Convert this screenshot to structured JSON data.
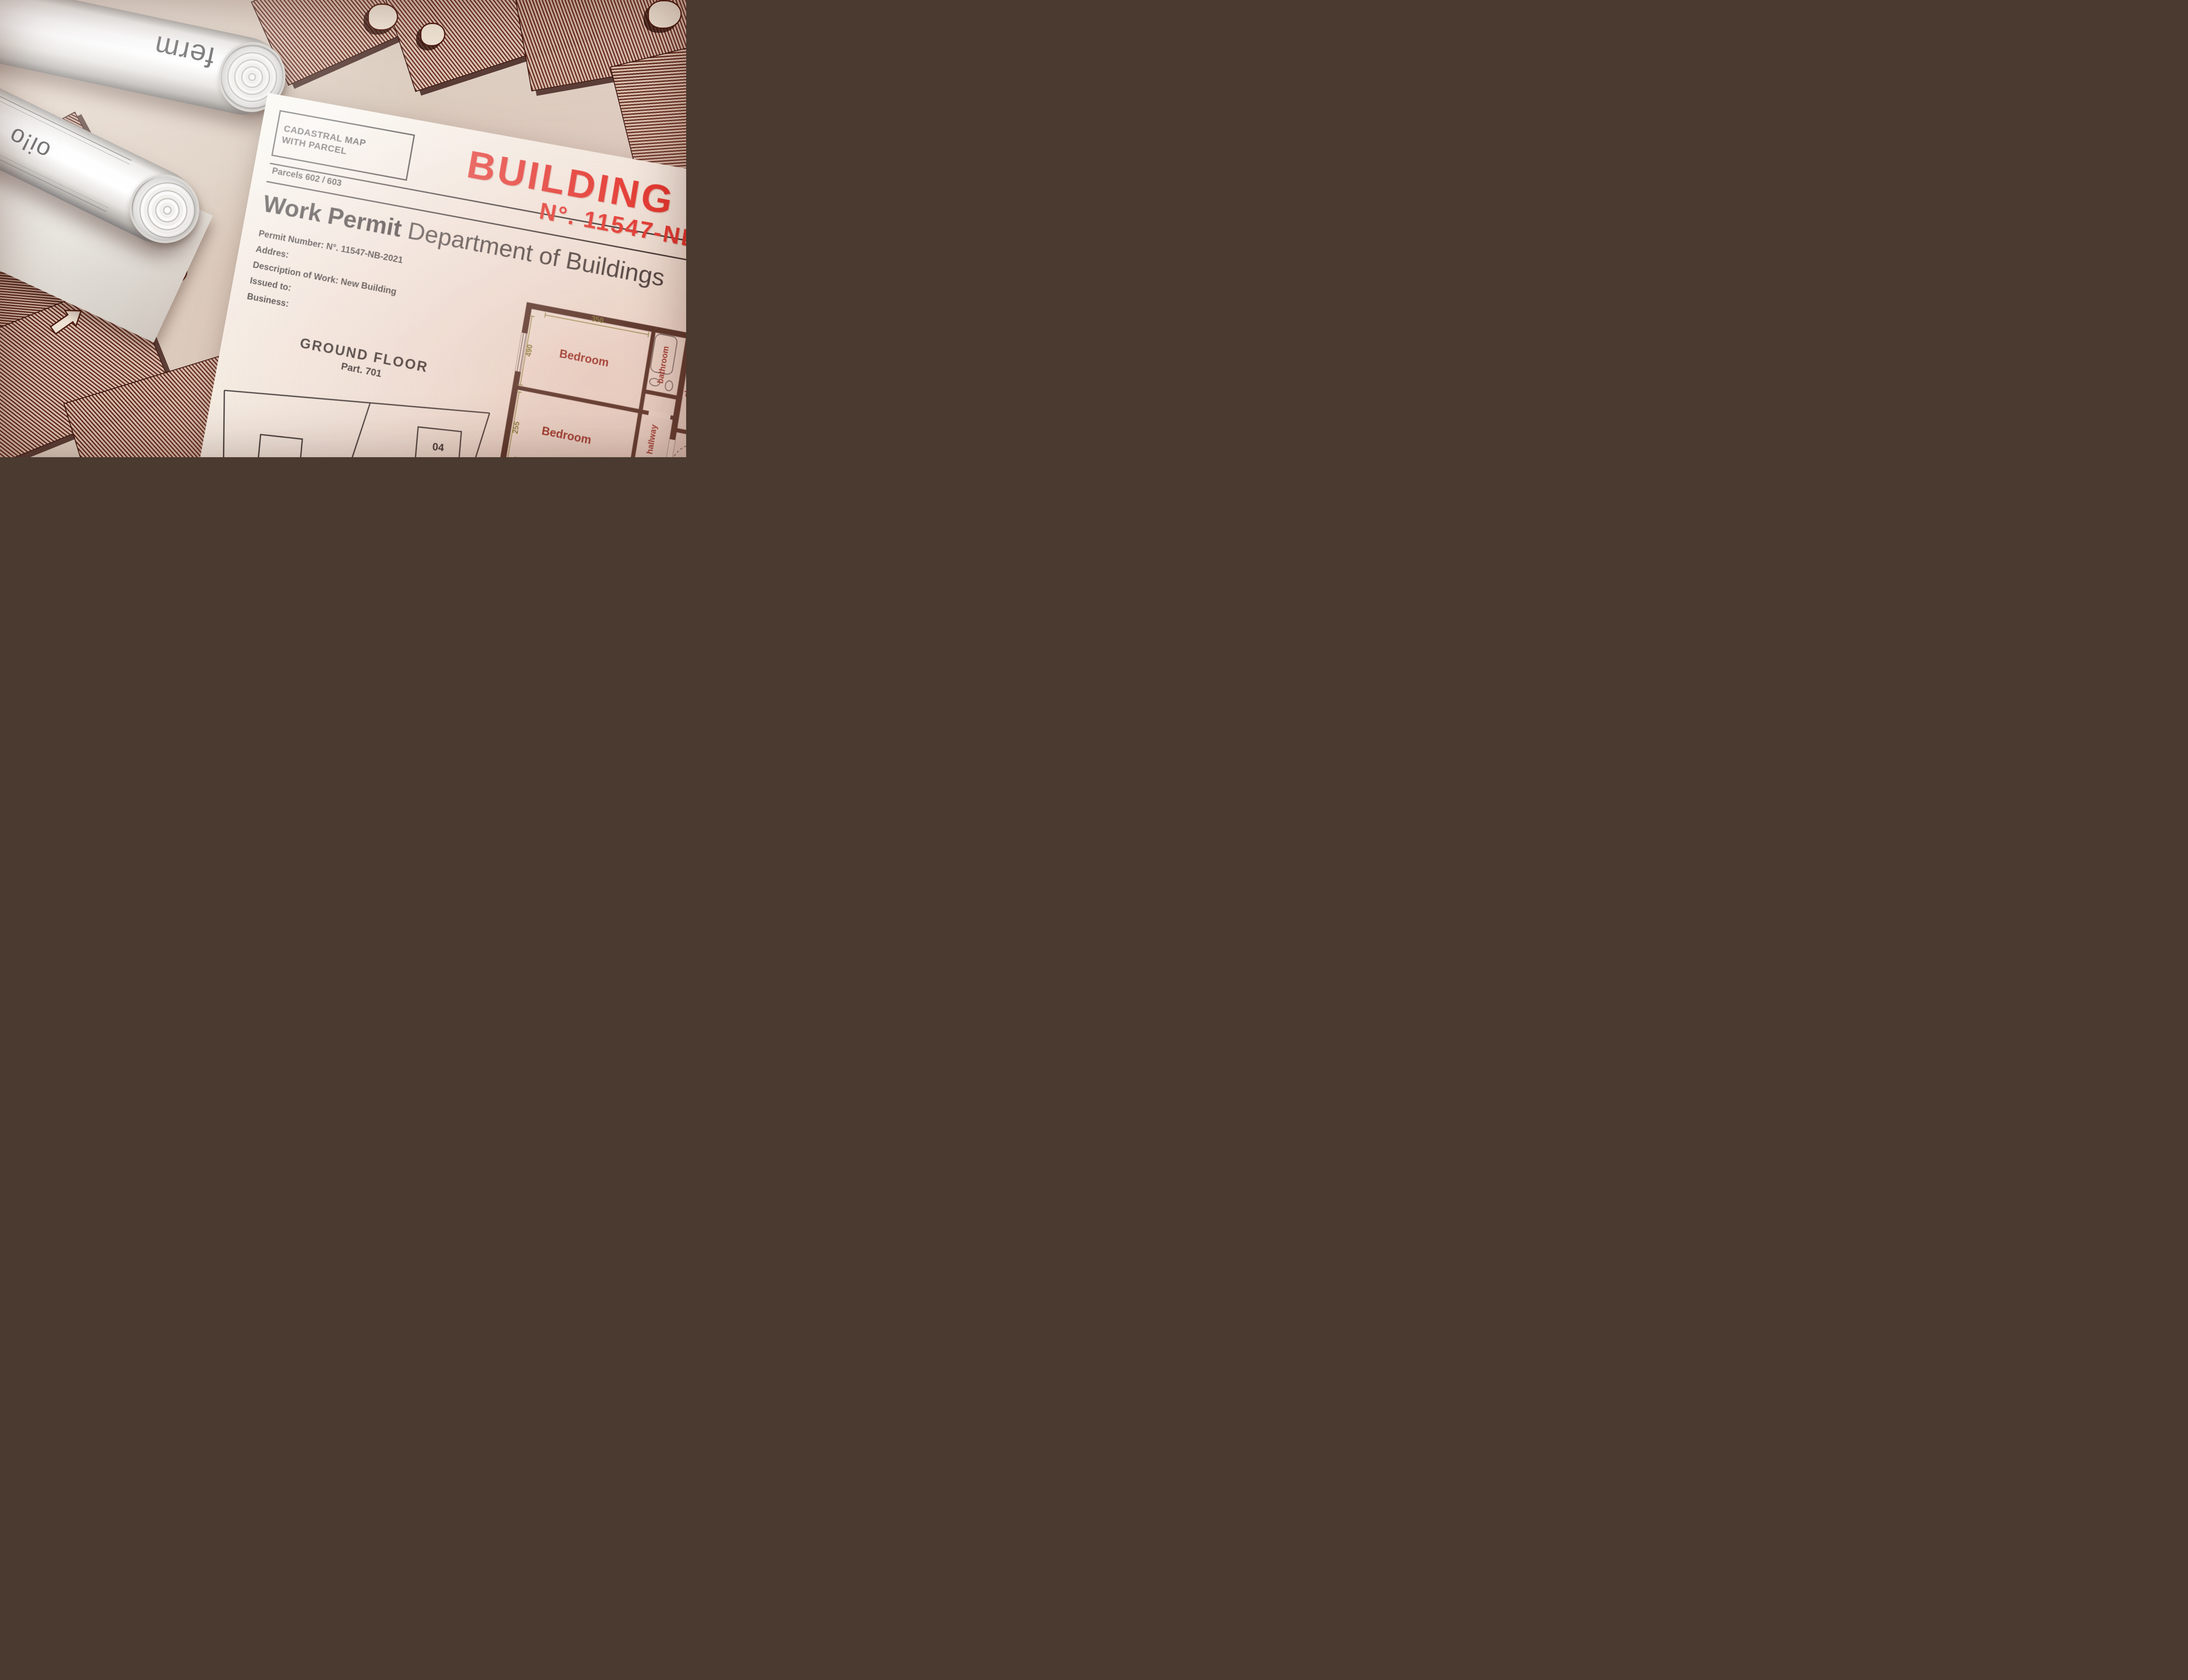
{
  "rolls": {
    "word1": "ferm",
    "word2": "oi!o",
    "badge": "19"
  },
  "doc": {
    "cadastral1": "CADASTRAL MAP",
    "cadastral2": "WITH PARCEL",
    "parcels": "Parcels 602 / 603",
    "title1": "BUILDING PERMIT",
    "title2": "N°. 11547-NB-2022",
    "sub_bold": "Work Permit",
    "sub_rest": "Department of Buildings",
    "fields": [
      "Permit Number: N°. 11547-NB-2021",
      "Addres:",
      "Description of Work: New Building",
      "Issued to:",
      "Business:"
    ],
    "protocol1": "Protocol n° 24459866",
    "protocol_date": "of 11/12/2021",
    "protocol2": "Cadastral Map n° 602/603",
    "scale": "Scale 1/500"
  },
  "ground": {
    "heading": "GROUND FLOOR",
    "sub": "Part. 701",
    "m04a": "04",
    "m04b": "04",
    "m03a": "03",
    "m03b": "03",
    "m01a": "01",
    "p603": "Part. 603",
    "m02a": "02",
    "m02b": "02",
    "m01b": "01",
    "p602": "Part. 602",
    "p813": "Part. 813",
    "p812": "Part. 812",
    "p206": "Part. 206",
    "p520": "Part. 520"
  },
  "plan": {
    "rooms": {
      "bedroom_l1": "Bedroom",
      "bedroom_l2": "Bedroom",
      "living_l": "living room",
      "bathroom_l": "bathroom",
      "hallway_l": "hallway",
      "closet": "closet",
      "stairwell": "stairwell",
      "entrance": "entrance",
      "bathroom_r": "bathroom",
      "bedroom_r1": "Bedroom",
      "hallway_r": "hallway",
      "bedroom_r2": "Bedroom",
      "living_r": "living room"
    },
    "dims": {
      "d350": "350",
      "d490": "490",
      "d255l": "255",
      "d380": "380",
      "d460": "460",
      "d515": "515",
      "d330": "3.30",
      "d440": "440",
      "d255r": "2.55",
      "d360": "360",
      "d225": "225",
      "d255c": "255",
      "d410": "410",
      "d545": "545",
      "d500": "500"
    }
  },
  "first_floor": {
    "heading": "FIRST FLOOR",
    "unit_a": "05",
    "unit_b": "05"
  },
  "scalebar": {
    "top": "3 meters",
    "mid": "2",
    "low": "1"
  }
}
